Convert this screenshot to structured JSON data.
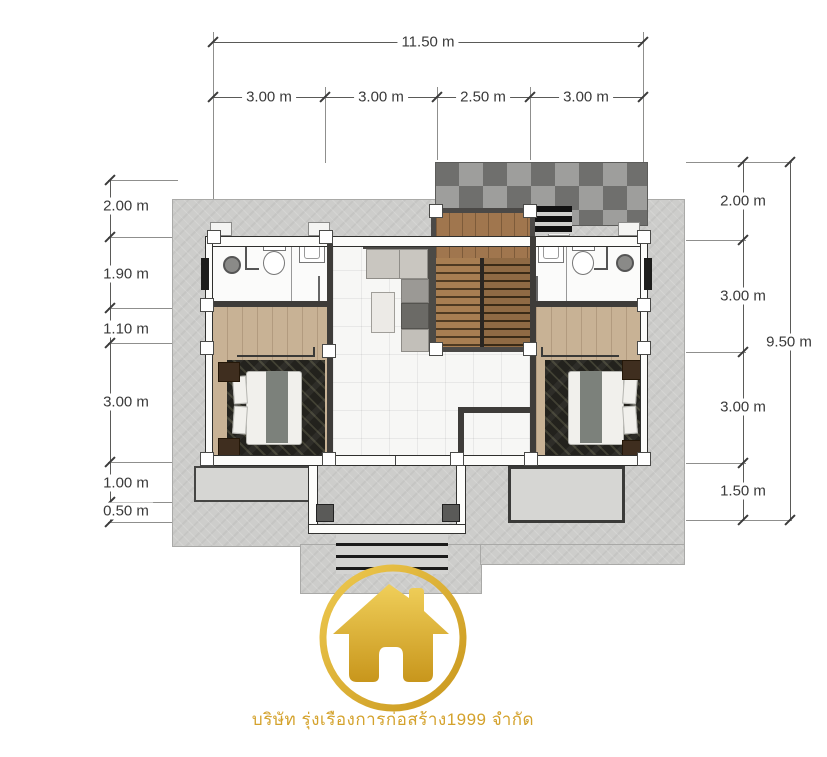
{
  "dimensions": {
    "top": {
      "total": "11.50 m",
      "segments": [
        "3.00 m",
        "3.00 m",
        "2.50 m",
        "3.00 m"
      ]
    },
    "left": {
      "segments": [
        "2.00 m",
        "1.90 m",
        "1.10 m",
        "3.00 m",
        "1.00 m",
        "0.50 m"
      ]
    },
    "right": {
      "total": "9.50 m",
      "segments": [
        "2.00 m",
        "3.00 m",
        "3.00 m",
        "1.50 m"
      ]
    }
  },
  "logo": {
    "company_name": "บริษัท รุ่งเรืองการก่อสร้าง1999 จำกัด"
  },
  "colors": {
    "slab": "#cdcdcb",
    "wall_dark": "#3e3c39",
    "checker_light": "#9e9e9c",
    "checker_dark": "#6f6f6d",
    "wood_floor": "#c8b295",
    "stair_wood": "#a87e52",
    "rug": "#23221d",
    "tile": "#f7f7f5",
    "gold": "#d4a22c",
    "sofa_cushion": "#c9c6c0",
    "sofa_frame": "#4c4a46"
  }
}
